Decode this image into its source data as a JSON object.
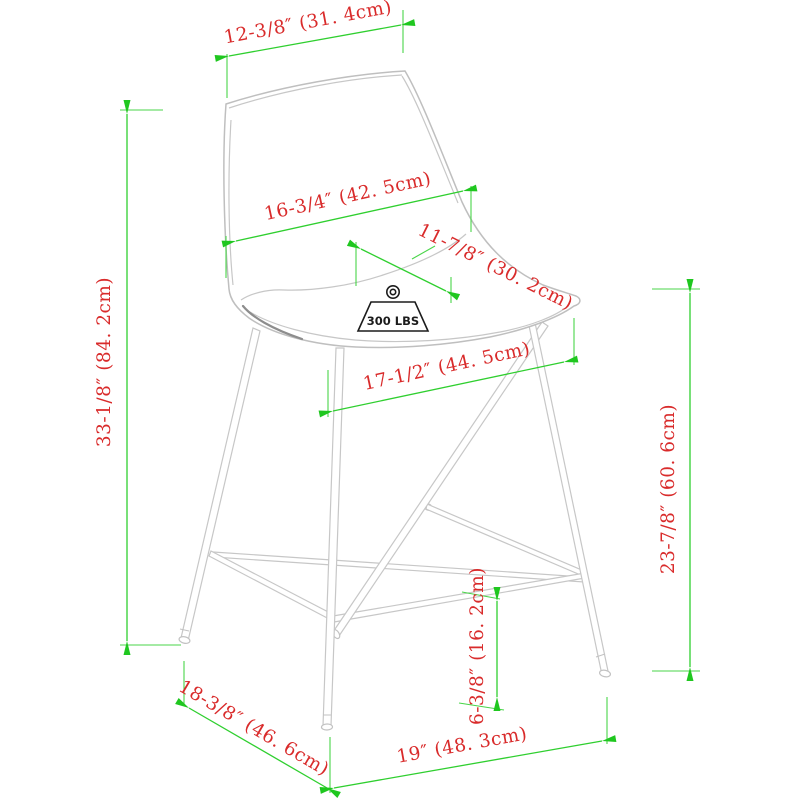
{
  "diagram": {
    "subject": "counter-height bar stool dimension drawing",
    "view": "three-quarter front-left isometric line drawing"
  },
  "weight_capacity": {
    "label": "300 LBS"
  },
  "dimensions": {
    "back_top_width": "12-3/8″ (31. 4cm)",
    "overall_height": "33-1/8″ (84. 2cm)",
    "back_height": "16-3/4″ (42. 5cm)",
    "seat_depth": "11-7/8″ (30. 2cm)",
    "seat_width": "17-1/2″ (44. 5cm)",
    "seat_height": "23-7/8″ (60. 6cm)",
    "footrest_height": "6-3/8″ (16. 2cm)",
    "base_depth": "18-3/8″ (46. 6cm)",
    "base_width": "19″ (48. 3cm)"
  },
  "colors": {
    "dimension_line": "#2fcf2f",
    "extension_line": "#49d549",
    "arrowhead": "#1fc71f",
    "dimension_text": "#d92b2b",
    "drawing_line": "#c7c7c7",
    "drawing_line_dark": "#8d8d8d",
    "weight_icon": "#1c1c1c",
    "background": "#ffffff"
  }
}
